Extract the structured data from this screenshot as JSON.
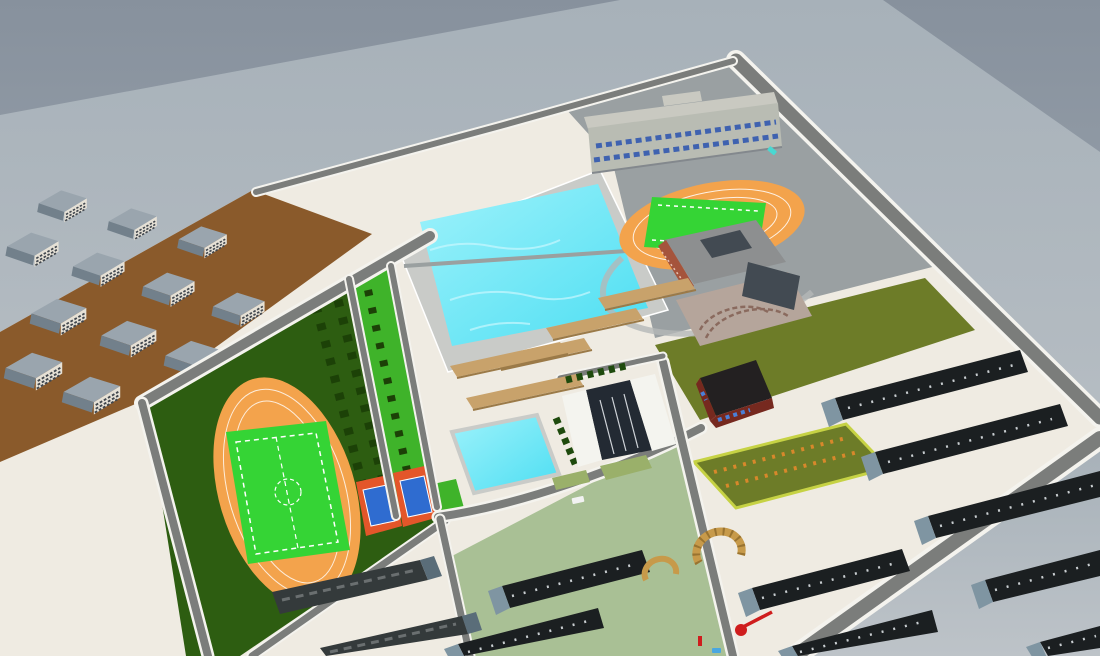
{
  "meta": {
    "app": "3d-campus-model-viewport",
    "view": "aerial-perspective-render"
  },
  "scene": {
    "description": "Aerial 3D render of a school campus master-plan model",
    "areas": [
      "residential-district",
      "athletics-field",
      "running-track",
      "football-pitch",
      "tennis-courts",
      "swimming-pool",
      "small-pool",
      "dormitory-rows",
      "classroom-building",
      "library-building",
      "second-track",
      "campus-gate",
      "tree-lined-lawn",
      "flower-garden",
      "olive-field",
      "sage-courtyard",
      "perimeter-roads"
    ],
    "counts": {
      "apartment_blocks": 12,
      "dormitory_rows_right": 5,
      "dormitory_rows_bottom": 2,
      "courtyard_rows": 2,
      "old_tile_roof_rows": 2,
      "tan_building_rows": 5,
      "tennis_courts": 2,
      "swimming_pools": 2,
      "running_tracks": 2,
      "entrance_arches": 2,
      "cars": 3
    }
  },
  "colors": {
    "sky_top": "#87919d",
    "sky_low": "#a9b2ba",
    "far_ground_top": "#a7b1b9",
    "far_ground_low": "#bdc3c8",
    "campus_ground": "#efebe2",
    "district_ground": "#8a5a2b",
    "road": "#7b7d7b",
    "road_edge": "#f4f3ee",
    "gray_zone": "#9aa0a2",
    "pool_deck": "#c9cbc8",
    "pool_water": "#4cdef2",
    "pool_water_light": "#9ef2fb",
    "sports_lawn": "#2d5d11",
    "strip_lawn": "#3fb32a",
    "pitch_green": "#35d435",
    "track_orange": "#f3a34c",
    "marking_white": "#ffffff",
    "tennis_surround": "#e3562a",
    "tennis_court": "#2f6cd0",
    "olive_field": "#6d7c28",
    "garden_border": "#c6d244",
    "garden_dot": "#d8882b",
    "sage_lawn": "#a9c095",
    "tan_building": "#c8a26b",
    "tan_shadow": "#9b7a48",
    "dorm_roof": "#1b1f21",
    "dorm_gable": "#7f95a2",
    "dorm_speckle": "#c9ced1",
    "old_roof": "#343a3b",
    "old_gable": "#5a6d79",
    "apartment_roof": "#9aa5ae",
    "apartment_roof_dark": "#72808b",
    "apartment_wall": "#e6e1d6",
    "apartment_band": "#41474e",
    "classroom_wall": "#b9bcb3",
    "classroom_roof": "#c9c9c1",
    "classroom_window": "#3f62b0",
    "gate_white": "#f4f4ef",
    "gate_glass": "#232a33",
    "barn_roof": "#232021",
    "barn_wall": "#76291f",
    "barn_window": "#4a80d8",
    "plaza": "#b5a59b",
    "plaza_arc": "#8a6a5e",
    "tex_roof": "#8d8f90",
    "tex_dark": "#424a52",
    "tex_red": "#a5543c",
    "sculpture_red": "#cf1d1d",
    "car_white": "#f2f2f2",
    "car_teal": "#49d8d2",
    "arch_gold": "#c79a4a",
    "tree_green": "#1c4107",
    "hedge_green": "#1e4a0d"
  }
}
